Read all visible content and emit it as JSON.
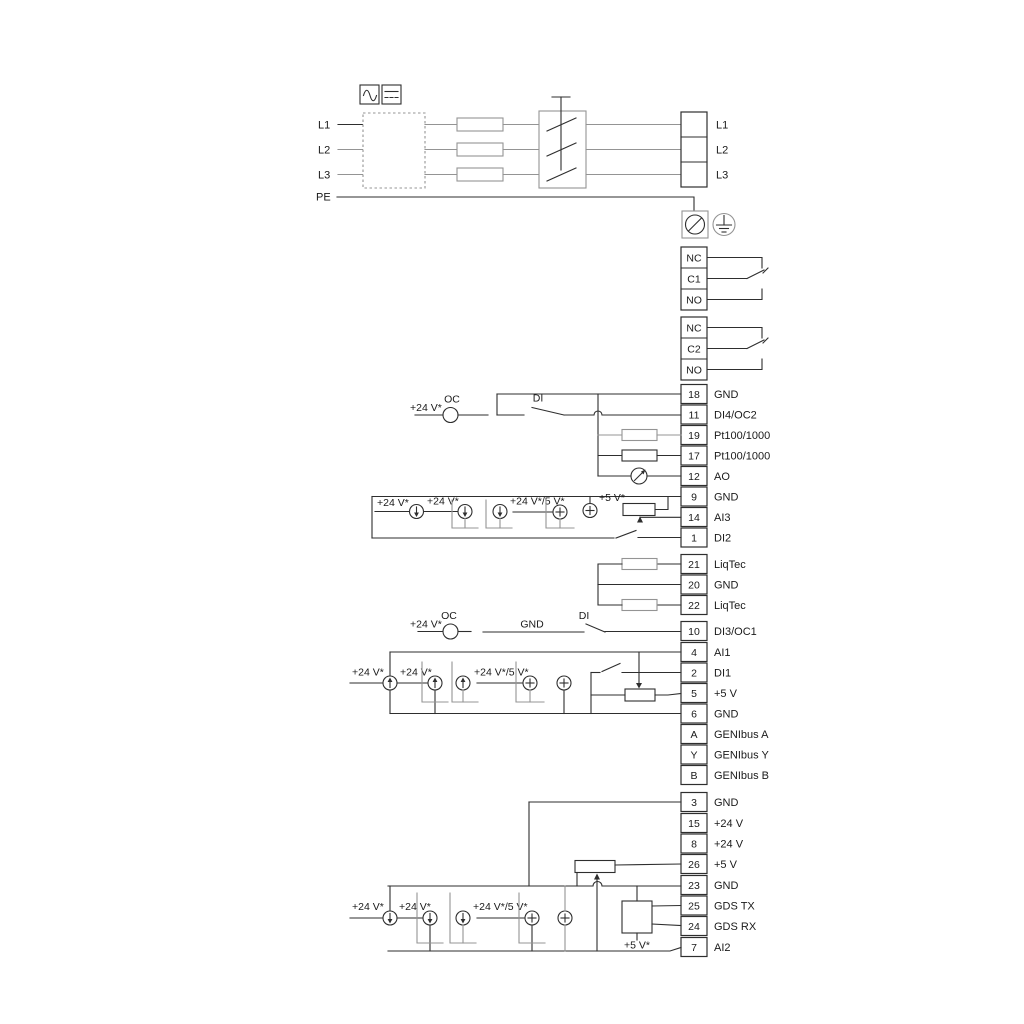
{
  "power": {
    "left_labels": [
      "L1",
      "L2",
      "L3",
      "PE"
    ],
    "right_labels": [
      "L1",
      "L2",
      "L3"
    ]
  },
  "relays": [
    {
      "terminals": [
        "NC",
        "C1",
        "NO"
      ]
    },
    {
      "terminals": [
        "NC",
        "C2",
        "NO"
      ]
    }
  ],
  "terminal_groups": {
    "group1": [
      {
        "no": "18",
        "label": "GND"
      },
      {
        "no": "11",
        "label": "DI4/OC2"
      },
      {
        "no": "19",
        "label": "Pt100/1000"
      },
      {
        "no": "17",
        "label": "Pt100/1000"
      },
      {
        "no": "12",
        "label": "AO"
      },
      {
        "no": "9",
        "label": "GND"
      },
      {
        "no": "14",
        "label": "AI3"
      },
      {
        "no": "1",
        "label": "DI2"
      }
    ],
    "liqtec": [
      {
        "no": "21",
        "label": "LiqTec"
      },
      {
        "no": "20",
        "label": "GND"
      },
      {
        "no": "22",
        "label": "LiqTec"
      }
    ],
    "group2": [
      {
        "no": "10",
        "label": "DI3/OC1"
      },
      {
        "no": "4",
        "label": "AI1"
      },
      {
        "no": "2",
        "label": "DI1"
      },
      {
        "no": "5",
        "label": "+5 V"
      },
      {
        "no": "6",
        "label": "GND"
      },
      {
        "no": "A",
        "label": "GENIbus A"
      },
      {
        "no": "Y",
        "label": "GENIbus Y"
      },
      {
        "no": "B",
        "label": "GENIbus B"
      }
    ],
    "group3": [
      {
        "no": "3",
        "label": "GND"
      },
      {
        "no": "15",
        "label": "+24 V"
      },
      {
        "no": "8",
        "label": "+24 V"
      },
      {
        "no": "26",
        "label": "+5 V"
      },
      {
        "no": "23",
        "label": "GND"
      },
      {
        "no": "25",
        "label": "GDS TX"
      },
      {
        "no": "24",
        "label": "GDS RX"
      },
      {
        "no": "7",
        "label": "AI2"
      }
    ]
  },
  "annotations": {
    "sec1": {
      "v24": "+24 V*",
      "oc": "OC",
      "di": "DI"
    },
    "ai3": {
      "v24a": "+24 V*",
      "v24b": "+24 V*",
      "v24v5": "+24 V*/5 V*",
      "v5": "+5 V*"
    },
    "sec2": {
      "v24": "+24 V*",
      "oc": "OC",
      "gnd": "GND",
      "di": "DI"
    },
    "ai1": {
      "v24a": "+24 V*",
      "v24b": "+24 V*",
      "v24v5": "+24 V*/5 V*"
    },
    "ai2": {
      "v24a": "+24 V*",
      "v24b": "+24 V*",
      "v24v5": "+24 V*/5 V*",
      "v5": "+5 V*"
    }
  },
  "colors": {
    "wire_dark": "#2e2e2e",
    "wire_gray": "#949494",
    "text": "#1a1a1a",
    "background": "#ffffff"
  }
}
